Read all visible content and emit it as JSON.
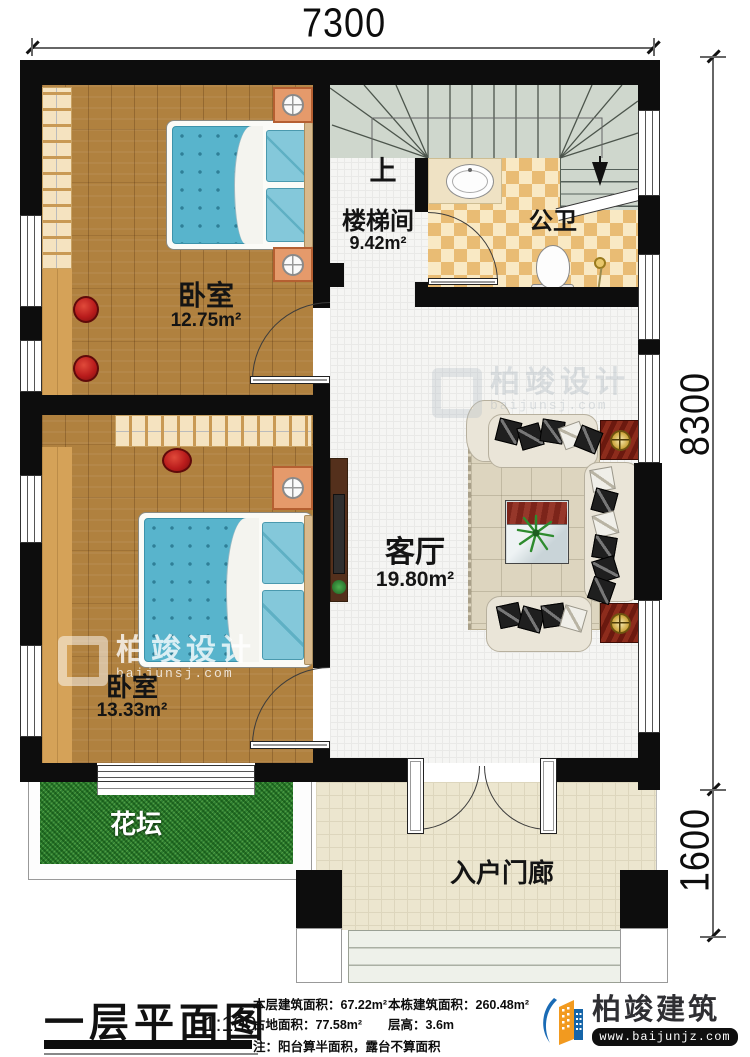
{
  "plan": {
    "type": "floor-plan",
    "floor": "一层"
  },
  "dimensions": {
    "width_top": "7300",
    "height_right": "8300",
    "porch_height": "1600"
  },
  "rooms": {
    "bedroom1": {
      "name": "卧室",
      "area": "12.75m²"
    },
    "bedroom2": {
      "name": "卧室",
      "area": "13.33m²"
    },
    "stairwell": {
      "name": "楼梯间",
      "area": "9.42m²"
    },
    "bathroom": {
      "name": "公卫"
    },
    "living_room": {
      "name": "客厅",
      "area": "19.80m²"
    },
    "flower_bed": {
      "name": "花坛"
    },
    "entry_porch": {
      "name": "入户门廊"
    }
  },
  "stairs": {
    "up_label": "上"
  },
  "title_block": {
    "title": "一层平面图",
    "scale": "1:100",
    "stats": [
      {
        "label": "本层建筑面积：",
        "value": "67.22m²"
      },
      {
        "label": "本栋建筑面积：",
        "value": "260.48m²"
      },
      {
        "label": "占地面积：",
        "value": "77.58m²"
      },
      {
        "label": "层高：",
        "value": "3.6m"
      }
    ],
    "note": "注：阳台算半面积，露台不算面积"
  },
  "brand": {
    "name": "柏竣建筑",
    "website": "www.baijunjz.com"
  },
  "watermark": {
    "name": "柏竣设计",
    "website": "baijunsj.com"
  },
  "colors": {
    "wall": "#0d0d0d",
    "wood_floor": "#b0813f",
    "mattress_blue": "#58b4cc",
    "grass_green": "#2e7d32",
    "bath_tile": "#e9bc74",
    "stair_gray": "#cfd7cd",
    "accent_red": "#7a2016",
    "brand_blue": "#1565a8",
    "brand_orange": "#f29a1f"
  }
}
